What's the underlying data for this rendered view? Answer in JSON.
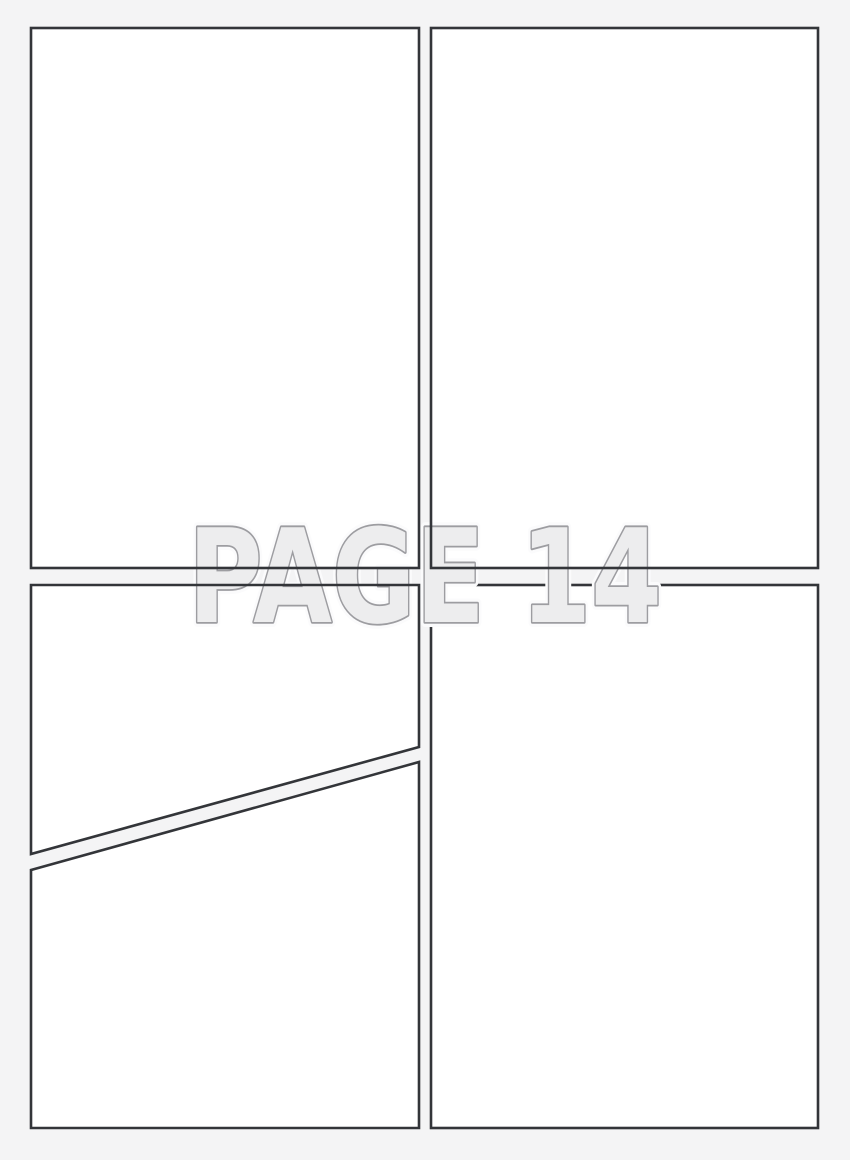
{
  "page": {
    "label": "PAGE 14",
    "panel_count": 4,
    "layout": "2x2 grid, bottom-left panel split diagonally",
    "colors": {
      "background": "#f4f4f5",
      "panel_fill": "#ffffff",
      "panel_border": "#333539",
      "label_fill": "#ededee",
      "label_outline": "#9d9da1",
      "label_halo": "#fbfbfc"
    }
  }
}
